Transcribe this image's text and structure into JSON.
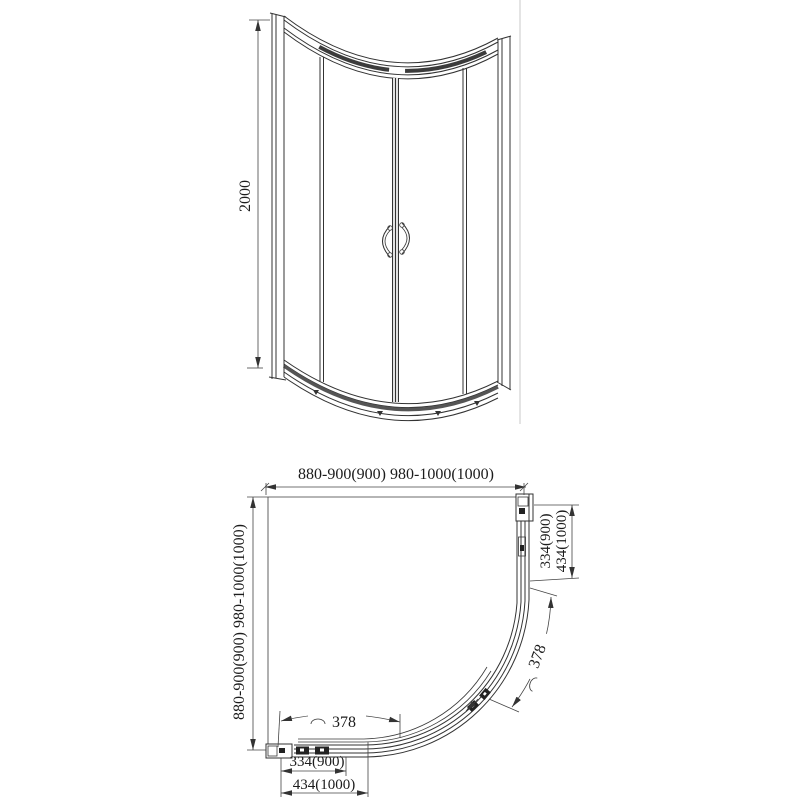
{
  "drawing": {
    "title": "quadrant-shower-enclosure-dimension-drawing",
    "front_view": {
      "height": "2000"
    },
    "plan_view": {
      "top_width": "880-900(900)  980-1000(1000)",
      "left_depth": "880-900(900)  980-1000(1000)",
      "right_dim_inner": "334(900)",
      "right_dim_outer": "434(1000)",
      "bottom_dim_inner": "334(900)",
      "bottom_dim_outer": "434(1000)",
      "arc_right": "378",
      "arc_bottom": "378"
    },
    "colors": {
      "line": "#333333",
      "dimension_line": "#444444",
      "dark_fill": "#222222",
      "faint_line": "#c9c9c9",
      "background": "#ffffff"
    }
  }
}
